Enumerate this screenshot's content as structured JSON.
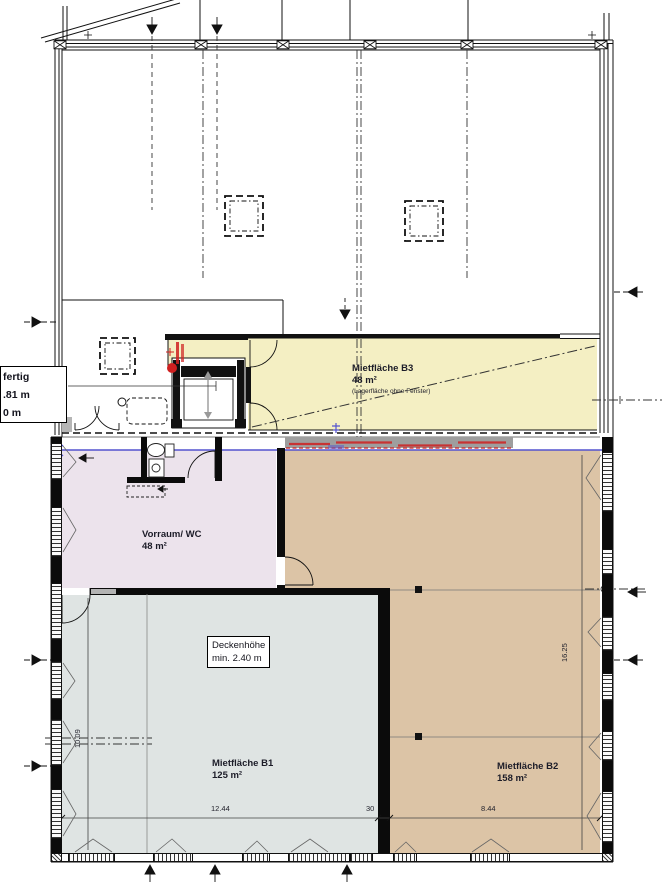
{
  "colors": {
    "b3_fill": "#f4efc3",
    "vorraum_fill": "#ece3ec",
    "b1_fill": "#dfe4e3",
    "b2_fill": "#dcc4a6",
    "wall": "#0b0b0b",
    "level_line_blue": "#5353cf",
    "markup_red": "#cf2020",
    "strip_gray": "#9e9e9e"
  },
  "rooms": {
    "b3": {
      "name": "Mietfläche B3",
      "area": "48 m²",
      "note": "(Lagerfläche ohne Fenster)"
    },
    "vorraum": {
      "name": "Vorraum/ WC",
      "area": "48 m²"
    },
    "b1": {
      "name": "Mietfläche B1",
      "area": "125 m²"
    },
    "b2": {
      "name": "Mietfläche B2",
      "area": "158 m²"
    }
  },
  "annotations": {
    "level_box": {
      "line1": "fertig",
      "line2": ".81 m",
      "line3": "0 m"
    },
    "ceiling_box": {
      "line1": "Deckenhöhe",
      "line2": "min. 2.40 m"
    }
  },
  "dimensions": {
    "b1_width": "12.44",
    "dividing_wall": "30",
    "b2_width": "8.44",
    "b1_depth": "10.09",
    "b2_depth": "16.25"
  }
}
